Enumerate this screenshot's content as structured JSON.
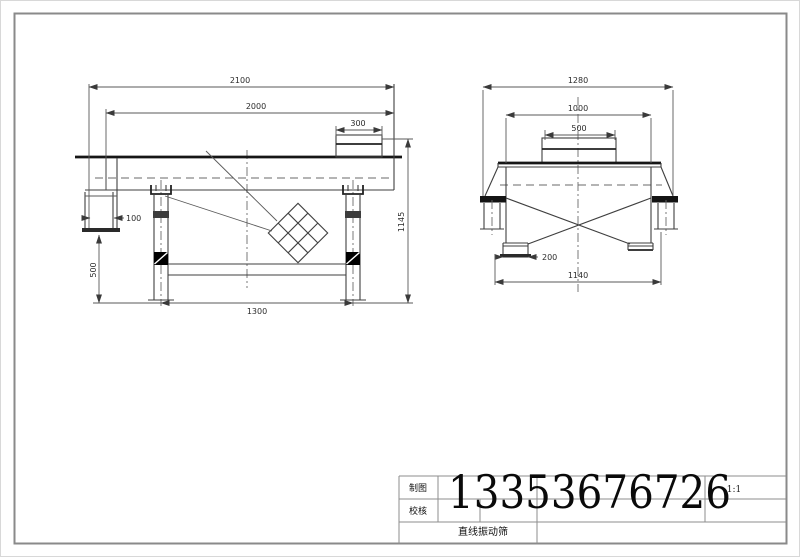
{
  "sheet": {
    "part_name": "直线振动筛",
    "phone": "13353676726",
    "scale": "1:1",
    "drafted_label": "制图",
    "checked_label": "校核"
  },
  "front_view": {
    "dims": {
      "total_length": "2100",
      "body_length": "2000",
      "motor_width": "300",
      "outlet_width": "100",
      "leg_height": "500",
      "leg_span": "1300",
      "total_height": "1145"
    }
  },
  "side_view": {
    "dims": {
      "total_width": "1280",
      "body_width": "1000",
      "motor_width": "500",
      "outlet_offset": "200",
      "base_width": "1140"
    }
  },
  "colors": {
    "ink": "#3f3f3f",
    "thick_line": "#161616",
    "dim_line": "#5a5a5a",
    "frame": "#8a8a8a",
    "paper": "#ffffff"
  }
}
